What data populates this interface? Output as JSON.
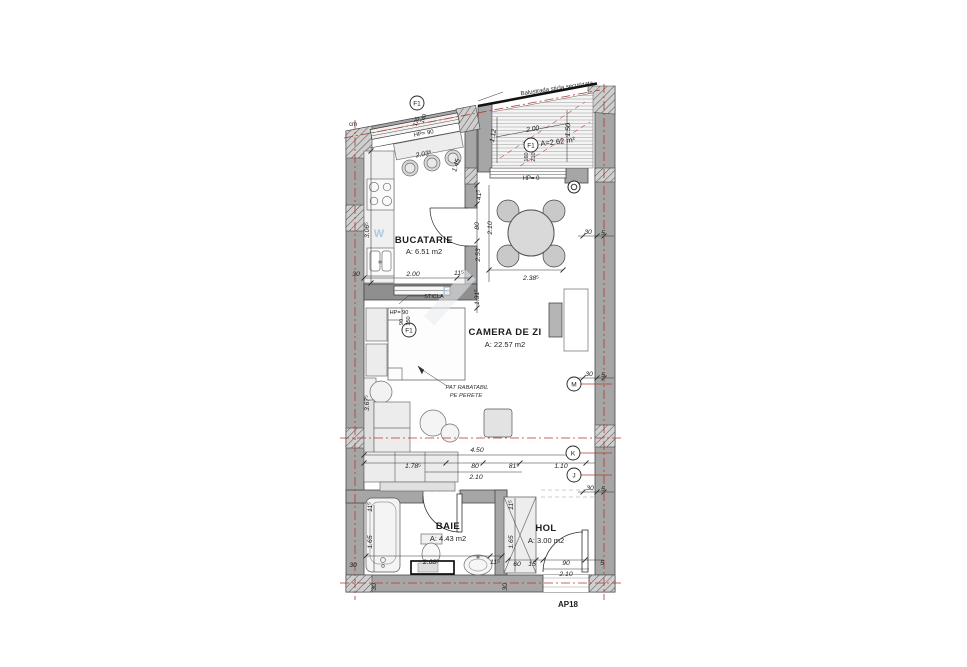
{
  "plan": {
    "code": "AP18",
    "unit_note": "cm"
  },
  "rooms": {
    "kitchen": {
      "name": "BUCATARIE",
      "area": "A: 6.51 m2"
    },
    "living": {
      "name": "CAMERA DE ZI",
      "area": "A: 22.57 m2"
    },
    "bath": {
      "name": "BAIE",
      "area": "A: 4.43 m2"
    },
    "hall": {
      "name": "HOL",
      "area": "A: 3.00 m2"
    },
    "balcony": {
      "area": "A=2.62 m²"
    }
  },
  "annotations": {
    "balustrade": "Balustrada sticla securizata",
    "glass": "STICLA",
    "foldbed_1": "PAT RABATABIL",
    "foldbed_2": "PE PERETE",
    "parapet_top": "HP= 90",
    "parapet_mid": "HP= 90",
    "parapet_balcony": "HP= 0",
    "watermark_w": "W",
    "watermark_f": "F"
  },
  "grid": {
    "window_tag": "F1",
    "m": "M",
    "k": "K",
    "j": "J"
  },
  "window_sizes": {
    "top_w": "140",
    "top_h": "135",
    "mid_w": "90",
    "mid_h": "150",
    "balcony_w": "160",
    "balcony_h": "210"
  },
  "dims": {
    "kitchen_top": "2.03⁵",
    "kitchen_width": "2.00",
    "kitchen_jamb": "11⁵",
    "kitchen_depth": "3.06⁵",
    "kitchen_diag": "1.45",
    "left_wall_30": "30",
    "balcony_width": "2.00",
    "balcony_right": "1.50",
    "balcony_left": "1.12",
    "chain_41": "41⁵",
    "chain_80": "80",
    "chain_210": "2.10",
    "chain_253": "2.53",
    "chain_131": "1.31⁵",
    "table_width": "2.38⁵",
    "wall_30_a": "30",
    "wall_5_a": "5",
    "wall_30_b": "30",
    "wall_5_b": "5",
    "wall_30_c": "30",
    "wall_5_c": "5",
    "living_depth": "3.67⁵",
    "sofa_total": "4.50",
    "sofa_len": "1.78⁵",
    "pass_80": "80",
    "pass_81": "81⁵",
    "pass_210": "2.10",
    "pass_110": "1.10",
    "bath_jamb": "11⁵",
    "bath_left": "1.65",
    "hall_left": "1.65",
    "hall_jamb": "11⁵",
    "bath_width": "2.68⁵",
    "bath_right_jamb": "11⁵",
    "hall_60": "60",
    "hall_15": "15",
    "door_90": "90",
    "door_5": "5",
    "door_210": "2.10",
    "bottom_30_a": "30",
    "bottom_30_b": "30",
    "left_30_low": "30"
  },
  "colors": {
    "wall": "#a6a6a6",
    "centerline": "#b03a2e",
    "watermark": "#a7c0dc"
  }
}
